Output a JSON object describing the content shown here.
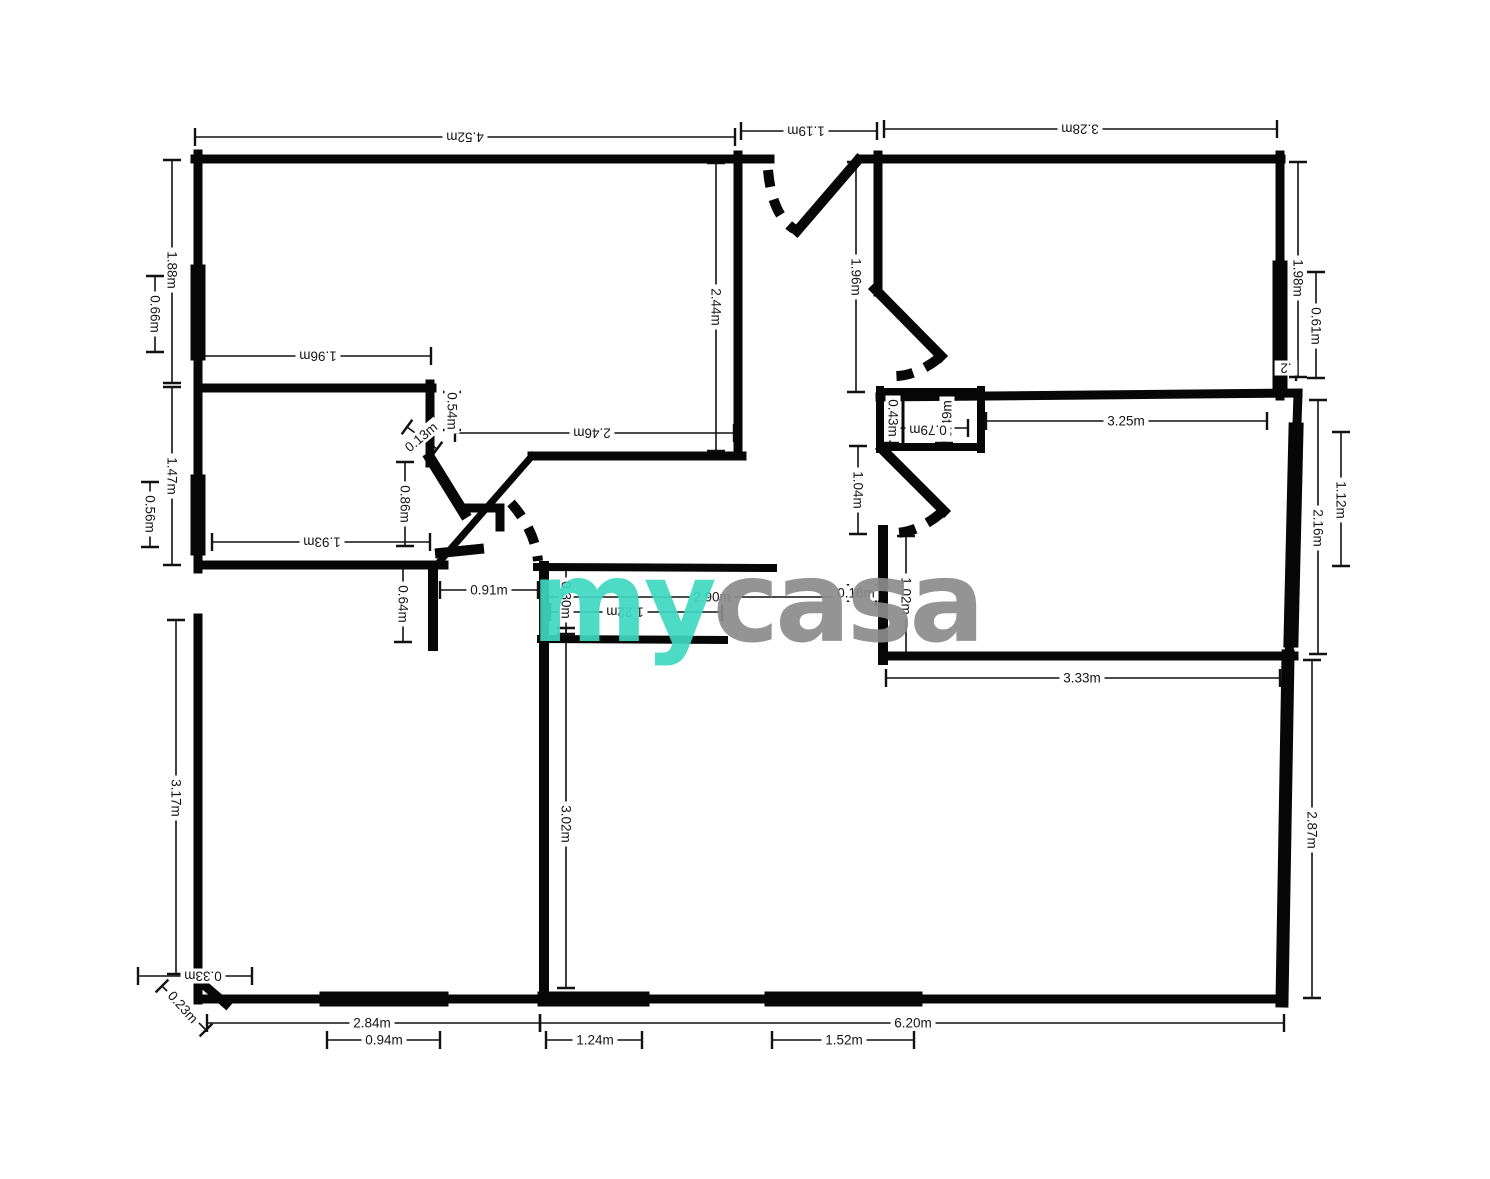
{
  "page": {
    "background": "#ffffff"
  },
  "watermark": {
    "my": "my",
    "casa": "casa",
    "my_color": "#3fd8c1",
    "casa_color": "#8c8c8c"
  },
  "units": "m",
  "labels": {
    "d452": "4.52m",
    "d119": "1.19m",
    "d328": "3.28m",
    "d188": "1.88m",
    "d066": "0.66m",
    "d196h": "1.96m",
    "d147": "1.47m",
    "d056": "0.56m",
    "d193": "1.93m",
    "d244": "2.44m",
    "d196v": "1.96m",
    "d246": "2.46m",
    "d054": "0.54m",
    "d013": "0.13m",
    "d086": "0.86m",
    "d064": "0.64m",
    "d091": "0.91m",
    "d030": "0.30m",
    "d290": "2.90m",
    "d016": "0.16m",
    "d122": "1.22m",
    "d302": "3.02m",
    "d317": "3.17m",
    "d033": "0.33m",
    "d023": "0.23m",
    "d284": "2.84m",
    "d094": "0.94m",
    "d620": "6.20m",
    "d124": "1.24m",
    "d152": "1.52m",
    "d104": "1.04m",
    "d102": "1.02m",
    "d043": "0.43m",
    "d049": "0.49m",
    "d079": "0.79m",
    "d325": "3.25m",
    "d198": "1.98m",
    "d061": "0.61m",
    "d02": ".2",
    "d216": "2.16m",
    "d112": "1.12m",
    "d333": "3.33m",
    "d287": "2.87m"
  },
  "plan": {
    "wall_color": "#070707",
    "walls": [
      {
        "d": "M195 159 L770 159",
        "w": 9
      },
      {
        "d": "M860 159 L1281 159",
        "w": 9
      },
      {
        "d": "M198 154 L198 388",
        "w": 9
      },
      {
        "d": "M198 272 L198 353",
        "w": 15
      },
      {
        "d": "M198 385 L198 569",
        "w": 9
      },
      {
        "d": "M198 482 L198 548",
        "w": 15
      },
      {
        "d": "M198 388 L432 388",
        "w": 9
      },
      {
        "d": "M430 384 L430 463",
        "w": 9
      },
      {
        "d": "M198 565 L444 565",
        "w": 9
      },
      {
        "d": "M738 155 L738 456",
        "w": 9
      },
      {
        "d": "M532 456 L742 456",
        "w": 9
      },
      {
        "d": "M532 456 L441 560",
        "w": 7
      },
      {
        "d": "M858 160 L797 231",
        "w": 10
      },
      {
        "d": "M878 155 L878 292",
        "w": 9
      },
      {
        "d": "M875 289 L941 356",
        "w": 10
      },
      {
        "d": "M880 392 L981 392",
        "w": 8
      },
      {
        "d": "M880 390 L880 449",
        "w": 8
      },
      {
        "d": "M880 447 L981 447",
        "w": 8
      },
      {
        "d": "M981 390 L981 449",
        "w": 8
      },
      {
        "d": "M903 392 L903 445",
        "w": 3
      },
      {
        "d": "M880 397 L1298 393",
        "w": 9
      },
      {
        "d": "M1280 155 L1280 396",
        "w": 9
      },
      {
        "d": "M1280 268 L1280 384",
        "w": 15
      },
      {
        "d": "M882 449 L944 511",
        "w": 10
      },
      {
        "d": "M883 530 L883 660",
        "w": 10
      },
      {
        "d": "M884 656 L1294 656",
        "w": 9
      },
      {
        "d": "M1298 394 L1289 658",
        "w": 9
      },
      {
        "d": "M1296 430 L1291 640",
        "w": 15
      },
      {
        "d": "M1288 656 L1282 1001",
        "w": 13
      },
      {
        "d": "M198 999 L1284 999",
        "w": 9
      },
      {
        "d": "M327 999 L441 999",
        "w": 15
      },
      {
        "d": "M545 999 L642 999",
        "w": 15
      },
      {
        "d": "M772 999 L915 999",
        "w": 15
      },
      {
        "d": "M198 618 L198 1000",
        "w": 9
      },
      {
        "d": "M196 978 L226 1004",
        "w": 9
      },
      {
        "d": "M537 567 L773 568",
        "w": 8
      },
      {
        "d": "M541 639 L724 640",
        "w": 8
      },
      {
        "d": "M544 566 L544 999",
        "w": 10
      },
      {
        "d": "M433 566 L433 646",
        "w": 10
      },
      {
        "d": "M430 458 L464 513",
        "w": 11
      },
      {
        "d": "M440 553 L479 549",
        "w": 10
      },
      {
        "d": "M468 508 L500 508 L500 527",
        "w": 9
      }
    ],
    "door_arcs": [
      {
        "d": "M768 170 Q772 215 794 229"
      },
      {
        "d": "M939 358 Q914 378 889 376"
      },
      {
        "d": "M941 513 Q916 534 891 533"
      },
      {
        "d": "M511 503 Q535 530 538 561"
      }
    ],
    "dims": [
      {
        "key": "d452",
        "x1": 195,
        "y1": 137,
        "x2": 735,
        "y2": 137,
        "lx": 465,
        "ly": 137,
        "rot": 180
      },
      {
        "key": "d119",
        "x1": 741,
        "y1": 131,
        "x2": 877,
        "y2": 131,
        "lx": 806,
        "ly": 131,
        "rot": 180
      },
      {
        "key": "d328",
        "x1": 884,
        "y1": 129,
        "x2": 1277,
        "y2": 129,
        "lx": 1080,
        "ly": 129,
        "rot": 180
      },
      {
        "key": "d188",
        "x1": 172,
        "y1": 160,
        "x2": 172,
        "y2": 383,
        "lx": 172,
        "ly": 270,
        "rot": 90
      },
      {
        "key": "d066",
        "x1": 155,
        "y1": 276,
        "x2": 155,
        "y2": 352,
        "lx": 155,
        "ly": 314,
        "rot": 90
      },
      {
        "key": "d196h",
        "x1": 198,
        "y1": 356,
        "x2": 431,
        "y2": 356,
        "lx": 318,
        "ly": 356,
        "rot": 180
      },
      {
        "key": "d147",
        "x1": 172,
        "y1": 387,
        "x2": 172,
        "y2": 565,
        "lx": 172,
        "ly": 476,
        "rot": 90
      },
      {
        "key": "d056",
        "x1": 150,
        "y1": 482,
        "x2": 150,
        "y2": 547,
        "lx": 150,
        "ly": 514,
        "rot": 90
      },
      {
        "key": "d193",
        "x1": 212,
        "y1": 542,
        "x2": 430,
        "y2": 542,
        "lx": 322,
        "ly": 542,
        "rot": 180
      },
      {
        "key": "d244",
        "x1": 716,
        "y1": 163,
        "x2": 716,
        "y2": 451,
        "lx": 716,
        "ly": 307,
        "rot": 90
      },
      {
        "key": "d196v",
        "x1": 856,
        "y1": 162,
        "x2": 856,
        "y2": 392,
        "lx": 856,
        "ly": 277,
        "rot": 90
      },
      {
        "key": "d246",
        "x1": 455,
        "y1": 433,
        "x2": 734,
        "y2": 433,
        "lx": 592,
        "ly": 433,
        "rot": 180
      },
      {
        "key": "d054",
        "x1": 452,
        "y1": 392,
        "x2": 452,
        "y2": 430,
        "lx": 452,
        "ly": 411,
        "rot": 90
      },
      {
        "key": "d013",
        "x1": 407,
        "y1": 427,
        "x2": 437,
        "y2": 449,
        "lx": 421,
        "ly": 437,
        "rot": -40
      },
      {
        "key": "d086",
        "x1": 405,
        "y1": 462,
        "x2": 405,
        "y2": 546,
        "lx": 405,
        "ly": 504,
        "rot": 90
      },
      {
        "key": "d064",
        "x1": 403,
        "y1": 568,
        "x2": 403,
        "y2": 642,
        "lx": 403,
        "ly": 604,
        "rot": 90
      },
      {
        "key": "d091",
        "x1": 440,
        "y1": 590,
        "x2": 538,
        "y2": 590,
        "lx": 489,
        "ly": 590,
        "rot": 0
      },
      {
        "key": "d030",
        "x1": 566,
        "y1": 568,
        "x2": 566,
        "y2": 634,
        "lx": 566,
        "ly": 600,
        "rot": 90
      },
      {
        "key": "d290",
        "x1": 548,
        "y1": 597,
        "x2": 876,
        "y2": 597,
        "lx": 712,
        "ly": 597,
        "rot": 0
      },
      {
        "key": "d016",
        "x1": 848,
        "y1": 593,
        "x2": 876,
        "y2": 593,
        "lx": 856,
        "ly": 593,
        "rot": 0
      },
      {
        "key": "d122",
        "x1": 550,
        "y1": 612,
        "x2": 722,
        "y2": 612,
        "lx": 625,
        "ly": 612,
        "rot": 180
      },
      {
        "key": "d302",
        "x1": 566,
        "y1": 628,
        "x2": 566,
        "y2": 988,
        "lx": 566,
        "ly": 824,
        "rot": 90
      },
      {
        "key": "d317",
        "x1": 176,
        "y1": 620,
        "x2": 176,
        "y2": 974,
        "lx": 176,
        "ly": 798,
        "rot": 90
      },
      {
        "key": "d033",
        "x1": 138,
        "y1": 976,
        "x2": 252,
        "y2": 976,
        "lx": 203,
        "ly": 976,
        "rot": 180
      },
      {
        "key": "d023",
        "x1": 162,
        "y1": 986,
        "x2": 206,
        "y2": 1030,
        "lx": 183,
        "ly": 1007,
        "rot": 48
      },
      {
        "key": "d284",
        "x1": 207,
        "y1": 1023,
        "x2": 540,
        "y2": 1023,
        "lx": 372,
        "ly": 1023,
        "rot": 0
      },
      {
        "key": "d094",
        "x1": 327,
        "y1": 1040,
        "x2": 440,
        "y2": 1040,
        "lx": 384,
        "ly": 1040,
        "rot": 0
      },
      {
        "key": "d620",
        "x1": 540,
        "y1": 1023,
        "x2": 1284,
        "y2": 1023,
        "lx": 913,
        "ly": 1023,
        "rot": 0
      },
      {
        "key": "d124",
        "x1": 546,
        "y1": 1040,
        "x2": 642,
        "y2": 1040,
        "lx": 595,
        "ly": 1040,
        "rot": 0
      },
      {
        "key": "d152",
        "x1": 772,
        "y1": 1040,
        "x2": 914,
        "y2": 1040,
        "lx": 844,
        "ly": 1040,
        "rot": 0
      },
      {
        "key": "d104",
        "x1": 858,
        "y1": 446,
        "x2": 858,
        "y2": 534,
        "lx": 858,
        "ly": 490,
        "rot": 90
      },
      {
        "key": "d102",
        "x1": 906,
        "y1": 536,
        "x2": 906,
        "y2": 655,
        "lx": 906,
        "ly": 596,
        "rot": 90
      },
      {
        "key": "d043",
        "x1": 890,
        "y1": 395,
        "x2": 890,
        "y2": 443,
        "lx": 893,
        "ly": 418,
        "rot": 90
      },
      {
        "key": "d049",
        "x1": 944,
        "y1": 395,
        "x2": 944,
        "y2": 443,
        "lx": 947,
        "ly": 419,
        "rot": -90
      },
      {
        "key": "d079",
        "x1": 888,
        "y1": 428,
        "x2": 968,
        "y2": 428,
        "lx": 928,
        "ly": 430,
        "rot": 180
      },
      {
        "key": "d325",
        "x1": 986,
        "y1": 421,
        "x2": 1267,
        "y2": 421,
        "lx": 1126,
        "ly": 421,
        "rot": 0
      },
      {
        "key": "d198",
        "x1": 1298,
        "y1": 162,
        "x2": 1298,
        "y2": 377,
        "lx": 1298,
        "ly": 278,
        "rot": 90
      },
      {
        "key": "d061",
        "x1": 1316,
        "y1": 272,
        "x2": 1316,
        "y2": 378,
        "lx": 1316,
        "ly": 326,
        "rot": 90
      },
      {
        "key": "d02",
        "x1": 1280,
        "y1": 372,
        "x2": 1296,
        "y2": 372,
        "lx": 1286,
        "ly": 368,
        "rot": 180
      },
      {
        "key": "d216",
        "x1": 1318,
        "y1": 400,
        "x2": 1318,
        "y2": 654,
        "lx": 1318,
        "ly": 528,
        "rot": 90
      },
      {
        "key": "d112",
        "x1": 1341,
        "y1": 432,
        "x2": 1341,
        "y2": 566,
        "lx": 1341,
        "ly": 500,
        "rot": 90
      },
      {
        "key": "d333",
        "x1": 886,
        "y1": 678,
        "x2": 1280,
        "y2": 678,
        "lx": 1082,
        "ly": 678,
        "rot": 0
      },
      {
        "key": "d287",
        "x1": 1312,
        "y1": 660,
        "x2": 1312,
        "y2": 998,
        "lx": 1312,
        "ly": 830,
        "rot": 90
      }
    ]
  }
}
